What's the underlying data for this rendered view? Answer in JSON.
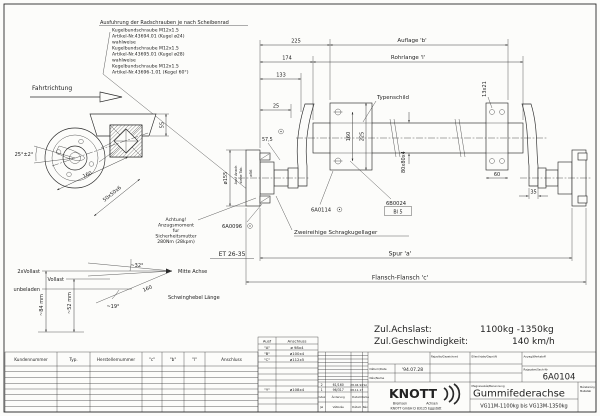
{
  "note": {
    "title": "Ausfuhrung der Radschrauben je nach Scheibenrad",
    "lines": [
      "Kugelbundschraube M12x1.5",
      "Artikel-Nr.43694.01 (Kugel ø24)",
      "wahlweise",
      "Kugelbundschraube M12x1.5",
      "Artikel-Nr.43695.01 (Kugel ø28)",
      "wahlweise",
      "Kegelbundschraube M12x1.5",
      "Artikel-Nr.43696-1.01 (Kegel 60°)"
    ]
  },
  "dir": "Fahrtrichtung",
  "front_view": {
    "angle": "25°±2°",
    "len160": "160",
    "h55": "55",
    "tube": "50x50x6"
  },
  "main": {
    "d25": "25",
    "d133": "133",
    "d174": "174",
    "d225": "225",
    "auflage": "Auflage 'b'",
    "rohrlange": "Rohrlange 'l'",
    "typenschild": "Typenschild",
    "slot": "13x21",
    "v160": "160",
    "v225": "225",
    "w60": "60",
    "w35": "35",
    "tube_section": "80x80x4",
    "d575": "57,5",
    "dia155": "ø155",
    "dia56": "ø56",
    "ausf1": "Ausf Ansch",
    "ausf2": "siehe Tab.",
    "et": "ET 26-35",
    "p6a0114": "6A0114",
    "p6b0024": "6B0024",
    "bl5": "Bl 5",
    "p6a0096": "6A0096",
    "bearing": "Zweireihige Schragkugellager",
    "spur": "Spur 'a'",
    "flansch": "Flansch-Flansch 'c'",
    "achtung": [
      "Achtung!",
      "Anzugsmoment",
      "fur",
      "Sicherheitsmutter",
      "280Nm (28kpm)"
    ]
  },
  "susp": {
    "l2": "2xVollast",
    "l1": "Vollast",
    "l0": "unbeladen",
    "a32": "~32°",
    "a19": "~19°",
    "mitte": "Mitte Achse",
    "len": "160",
    "hebel": "Schwinghebel Länge",
    "t84": "~84 mm",
    "t52": "~52 mm"
  },
  "ratings": {
    "load_label": "Zul.Achslast:",
    "load_value": "1100kg -1350kg",
    "speed_label": "Zul.Geschwindigkeit:",
    "speed_value": "140 km/h"
  },
  "ctable": {
    "h": [
      "Kundennummer",
      "Typ.",
      "Herstellernummer",
      "\"c\"",
      "\"b\"",
      "\"l\"",
      "Anschluss"
    ]
  },
  "atable": {
    "h1": "Ausf",
    "h2": "Anschluss",
    "rows": [
      [
        "\"A\"",
        "ø 98x4"
      ],
      [
        "\"B\"",
        "ø100x4"
      ],
      [
        "\"C\"",
        "ø112x5"
      ],
      [
        "\"Y\"",
        "ø108x4"
      ]
    ]
  },
  "tb": {
    "drawn": "Rajzolta/Gezeichnet",
    "checked": "Ellenőrizte/Geprüft",
    "date_l": "Dátum/Date",
    "date": "'94.07.28",
    "name_l": "Név/Name",
    "mat": "Anyag/Werkstoff",
    "no_l": "Rajzszám/Sach-Nr",
    "no": "6A0104",
    "ben_l": "Megnevezés/Benennung",
    "ben": "Gummifederachse",
    "range": "VG11M-1100kg bis VG13M-1350kg",
    "scale1": "Méretarány",
    "scale2": "Maßstab",
    "logo": "KNOTT",
    "brand1": "Bremsen",
    "brand2": "Achsen",
    "addr": "KNOTT GmbH D 83125 Eggstätt",
    "rev": {
      "r1": [
        "2",
        "61/160",
        "28.04.94",
        "Sz"
      ],
      "r2": [
        "1",
        "96/317",
        "08.11.17",
        ""
      ],
      "de": [
        "Index",
        "Änderung",
        "Datum",
        "Name"
      ],
      "hu": [
        "Jel",
        "Változás",
        "Dátum",
        "Név"
      ]
    }
  },
  "colors": {
    "ink": "#2a2a2a",
    "paper": "#fcfcfa"
  }
}
